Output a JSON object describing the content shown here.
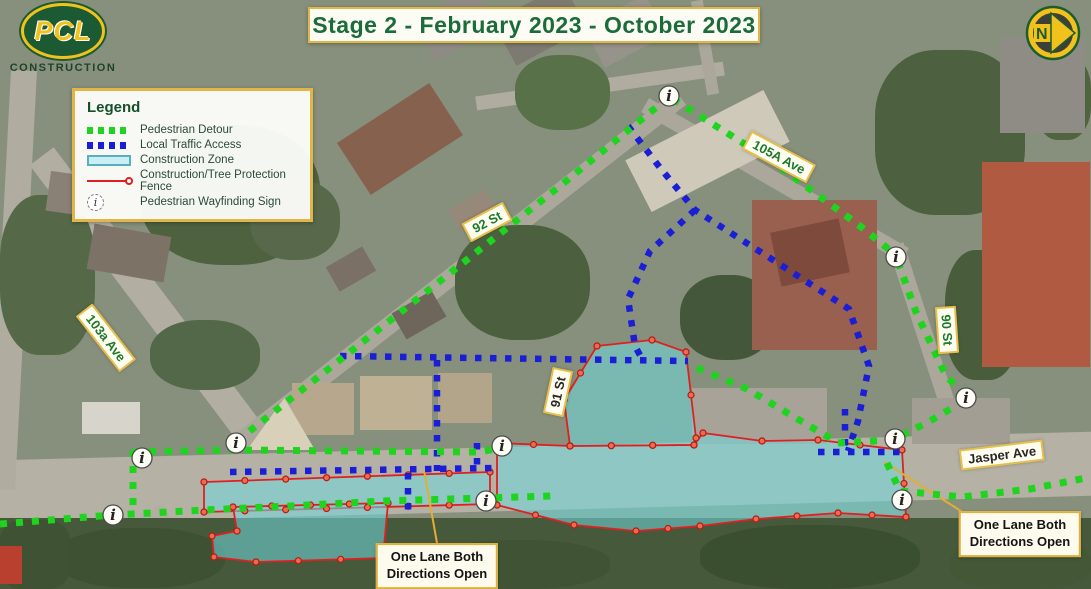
{
  "header": {
    "title": "Stage 2 - February 2023 - October 2023"
  },
  "logo": {
    "brand": "PCL",
    "subtitle": "CONSTRUCTION"
  },
  "north_indicator": {
    "label": "N"
  },
  "legend": {
    "title": "Legend",
    "items": [
      {
        "key": "pedestrian-detour",
        "label": "Pedestrian Detour",
        "color": "#1ed41e"
      },
      {
        "key": "local-traffic-access",
        "label": "Local Traffic Access",
        "color": "#1a1fd6"
      },
      {
        "key": "construction-zone",
        "label": "Construction Zone",
        "color": "#c9eef3"
      },
      {
        "key": "construction-fence",
        "label": "Construction/Tree Protection Fence",
        "color": "#e02020"
      },
      {
        "key": "wayfinding-sign",
        "label": "Pedestrian Wayfinding Sign",
        "color": "#ffffff"
      }
    ]
  },
  "colors": {
    "detour_green": "#1ed41e",
    "traffic_blue": "#1a1fd6",
    "zone_fill": "#6fd9de",
    "zone_fill_opacity": 0.55,
    "fence_red": "#e02020",
    "fence_dot_fill": "#ef6a55",
    "leader_yellow": "#e2ae34",
    "label_green": "#1c7a2e",
    "label_dark": "#262626",
    "accent_border": "#e2b646"
  },
  "street_labels": [
    {
      "text": "103a Ave",
      "x": 106,
      "y": 338,
      "rot": 52,
      "tone": "green"
    },
    {
      "text": "92 St",
      "x": 487,
      "y": 222,
      "rot": -28,
      "tone": "green"
    },
    {
      "text": "105A Ave",
      "x": 779,
      "y": 157,
      "rot": 28,
      "tone": "green"
    },
    {
      "text": "90 St",
      "x": 947,
      "y": 330,
      "rot": 86,
      "tone": "green"
    },
    {
      "text": "91 St",
      "x": 558,
      "y": 392,
      "rot": -78,
      "tone": "dark"
    },
    {
      "text": "Jasper Ave",
      "x": 1002,
      "y": 455,
      "rot": -7,
      "tone": "dark"
    }
  ],
  "callouts": [
    {
      "lines": [
        "One Lane Both",
        "Directions Open"
      ],
      "x": 437,
      "y": 566
    },
    {
      "lines": [
        "One Lane Both",
        "Directions Open"
      ],
      "x": 1020,
      "y": 534
    }
  ],
  "map": {
    "construction_zones": [
      [
        [
          597,
          346
        ],
        [
          652,
          340
        ],
        [
          686,
          352
        ],
        [
          696,
          438
        ],
        [
          694,
          445
        ],
        [
          570,
          446
        ],
        [
          564,
          400
        ]
      ],
      [
        [
          497,
          443
        ],
        [
          570,
          446
        ],
        [
          694,
          445
        ],
        [
          703,
          433
        ],
        [
          762,
          441
        ],
        [
          818,
          440
        ],
        [
          902,
          450
        ],
        [
          906,
          517
        ],
        [
          838,
          513
        ],
        [
          756,
          519
        ],
        [
          700,
          526
        ],
        [
          636,
          531
        ],
        [
          574,
          525
        ],
        [
          497,
          505
        ]
      ],
      [
        [
          204,
          482
        ],
        [
          490,
          472
        ],
        [
          490,
          504
        ],
        [
          204,
          512
        ]
      ],
      [
        [
          233,
          507
        ],
        [
          388,
          503
        ],
        [
          383,
          558
        ],
        [
          256,
          562
        ],
        [
          214,
          557
        ],
        [
          212,
          536
        ],
        [
          237,
          531
        ]
      ]
    ],
    "pedestrian_detour_paths": [
      [
        [
          0,
          524
        ],
        [
          113,
          515
        ],
        [
          205,
          510
        ],
        [
          290,
          506
        ],
        [
          383,
          501
        ],
        [
          486,
          498
        ],
        [
          552,
          496
        ]
      ],
      [
        [
          133,
          452
        ],
        [
          230,
          450
        ],
        [
          480,
          452
        ],
        [
          499,
          448
        ]
      ],
      [
        [
          133,
          450
        ],
        [
          133,
          507
        ]
      ],
      [
        [
          237,
          441
        ],
        [
          430,
          289
        ],
        [
          560,
          186
        ],
        [
          664,
          101
        ]
      ],
      [
        [
          673,
          99
        ],
        [
          770,
          160
        ],
        [
          860,
          226
        ],
        [
          892,
          252
        ]
      ],
      [
        [
          898,
          262
        ],
        [
          916,
          312
        ],
        [
          946,
          376
        ],
        [
          964,
          394
        ]
      ],
      [
        [
          964,
          401
        ],
        [
          930,
          421
        ],
        [
          899,
          437
        ]
      ],
      [
        [
          893,
          440
        ],
        [
          838,
          443
        ]
      ],
      [
        [
          697,
          368
        ],
        [
          747,
          389
        ],
        [
          801,
          421
        ],
        [
          835,
          441
        ]
      ],
      [
        [
          887,
          463
        ],
        [
          900,
          491
        ],
        [
          962,
          497
        ],
        [
          1030,
          489
        ],
        [
          1091,
          477
        ]
      ]
    ],
    "local_traffic_paths": [
      [
        [
          628,
          126
        ],
        [
          661,
          169
        ],
        [
          695,
          210
        ],
        [
          770,
          258
        ],
        [
          849,
          309
        ],
        [
          869,
          366
        ],
        [
          858,
          421
        ],
        [
          848,
          451
        ]
      ],
      [
        [
          695,
          210
        ],
        [
          650,
          251
        ],
        [
          628,
          299
        ],
        [
          635,
          346
        ],
        [
          641,
          357
        ]
      ],
      [
        [
          340,
          356
        ],
        [
          688,
          361
        ]
      ],
      [
        [
          437,
          360
        ],
        [
          437,
          471
        ]
      ],
      [
        [
          477,
          443
        ],
        [
          477,
          469
        ]
      ],
      [
        [
          230,
          472
        ],
        [
          497,
          468
        ]
      ],
      [
        [
          408,
          473
        ],
        [
          408,
          513
        ]
      ],
      [
        [
          818,
          452
        ],
        [
          908,
          452
        ]
      ],
      [
        [
          845,
          409
        ],
        [
          845,
          450
        ]
      ]
    ],
    "leader_lines": [
      [
        [
          424,
          470
        ],
        [
          437,
          543
        ]
      ],
      [
        [
          884,
          462
        ],
        [
          975,
          520
        ]
      ]
    ],
    "wayfinding_signs": [
      {
        "x": 113,
        "y": 515
      },
      {
        "x": 142,
        "y": 458
      },
      {
        "x": 236,
        "y": 443
      },
      {
        "x": 502,
        "y": 446
      },
      {
        "x": 486,
        "y": 501
      },
      {
        "x": 669,
        "y": 96
      },
      {
        "x": 896,
        "y": 257
      },
      {
        "x": 966,
        "y": 398
      },
      {
        "x": 895,
        "y": 439
      },
      {
        "x": 902,
        "y": 500
      }
    ]
  }
}
